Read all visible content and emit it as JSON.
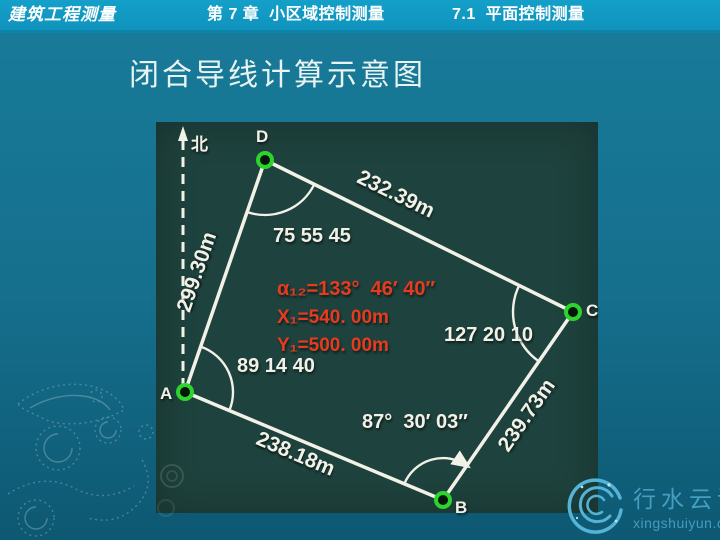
{
  "header": {
    "course": "建筑工程测量",
    "chapter": "第 7 章  小区域控制测量",
    "section": "7.1  平面控制测量"
  },
  "slide": {
    "title": "闭合导线计算示意图"
  },
  "diagram": {
    "description": "closed-traverse-calculation-schematic",
    "north_label": "北",
    "points": [
      {
        "id": "A"
      },
      {
        "id": "B"
      },
      {
        "id": "C"
      },
      {
        "id": "D"
      }
    ],
    "sides": [
      {
        "from": "A",
        "to": "B",
        "length": "238.18m"
      },
      {
        "from": "B",
        "to": "C",
        "length": "239.73m"
      },
      {
        "from": "C",
        "to": "D",
        "length": "232.39m"
      },
      {
        "from": "D",
        "to": "A",
        "length": "299.30m"
      }
    ],
    "angles": [
      {
        "at": "D",
        "value": "75 55 45"
      },
      {
        "at": "A",
        "value": "89 14 40"
      },
      {
        "at": "B",
        "value": "87°  30′ 03″"
      },
      {
        "at": "C",
        "value": "127 20 10"
      }
    ],
    "known_values": {
      "azimuth": "α₁₂=133°  46′ 40″",
      "x0": "X₁=540. 00m",
      "y0": "Y₁=500. 00m"
    }
  },
  "watermark": {
    "logo_text": "行水云课",
    "site": "xingshuiyun.com"
  },
  "colors": {
    "header_bg": "#14a0c9",
    "header_underline": "#0d84a9",
    "body_top": "#187c9a",
    "body_bottom": "#0d5872",
    "diagram_bg": "#1e423d",
    "line_white": "#f2f1e8",
    "known_red": "#e83a1f",
    "marker_green": "#2ed32e",
    "logo_blue": "#55b3d7",
    "watermark_text": "#4aa4c6",
    "title_white": "#e9f3f2"
  }
}
